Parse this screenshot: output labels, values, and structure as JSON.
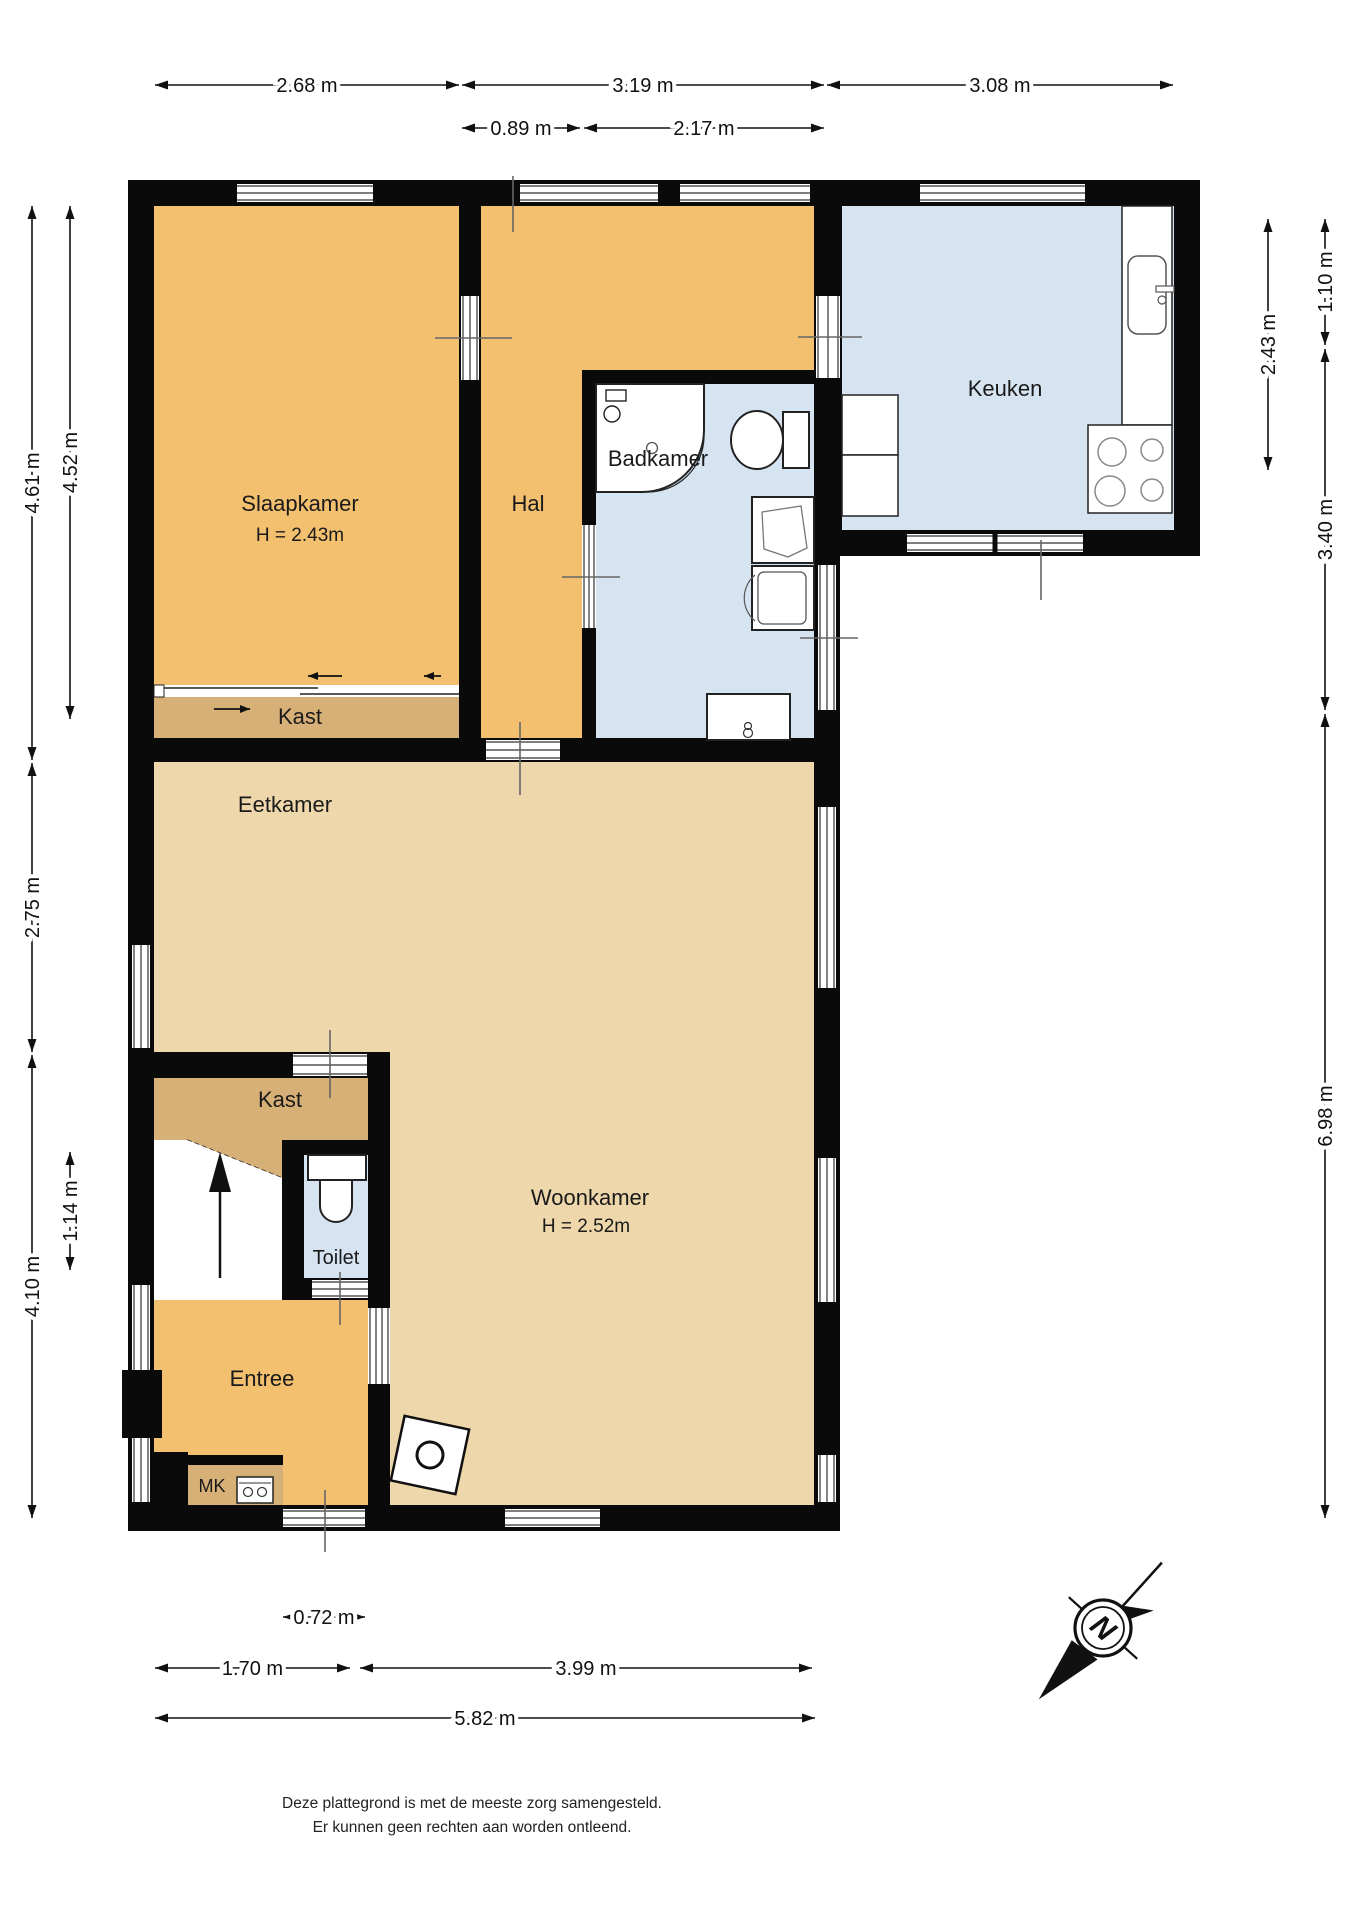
{
  "rooms": {
    "slaapkamer": {
      "label": "Slaapkamer",
      "height_note": "H = 2.43m"
    },
    "hal": {
      "label": "Hal"
    },
    "badkamer": {
      "label": "Badkamer"
    },
    "keuken": {
      "label": "Keuken"
    },
    "kast1": {
      "label": "Kast"
    },
    "kast2": {
      "label": "Kast"
    },
    "eetkamer": {
      "label": "Eetkamer"
    },
    "woonkamer": {
      "label": "Woonkamer",
      "height_note": "H = 2.52m"
    },
    "toilet": {
      "label": "Toilet"
    },
    "entree": {
      "label": "Entree"
    },
    "mk": {
      "label": "MK"
    }
  },
  "dims": {
    "top1": "2.68 m",
    "top2": "3.19 m",
    "top3": "3.08 m",
    "top4": "0.89 m",
    "top5": "2.17 m",
    "left1": "4.61 m",
    "left2": "4.52 m",
    "left3": "2.75 m",
    "left4": "1.14 m",
    "left5": "4.10 m",
    "right1": "2.43 m",
    "right2": "1.10 m",
    "right3": "3.40 m",
    "right4": "6.98 m",
    "bottom1": "0.72 m",
    "bottom2": "1.70 m",
    "bottom3": "3.99 m",
    "bottom4": "5.82 m"
  },
  "compass": {
    "north_label": "N"
  },
  "footer": {
    "line1": "Deze plattegrond is met de meeste zorg samengesteld.",
    "line2": "Er kunnen geen rechten aan worden ontleend."
  },
  "colors": {
    "wall": "#0a0a0a",
    "orange": "#f3c06f",
    "tan": "#d7b077",
    "beige": "#eed7ab",
    "blue": "#d6e4f2",
    "line": "#111111",
    "tick": "#666666"
  }
}
